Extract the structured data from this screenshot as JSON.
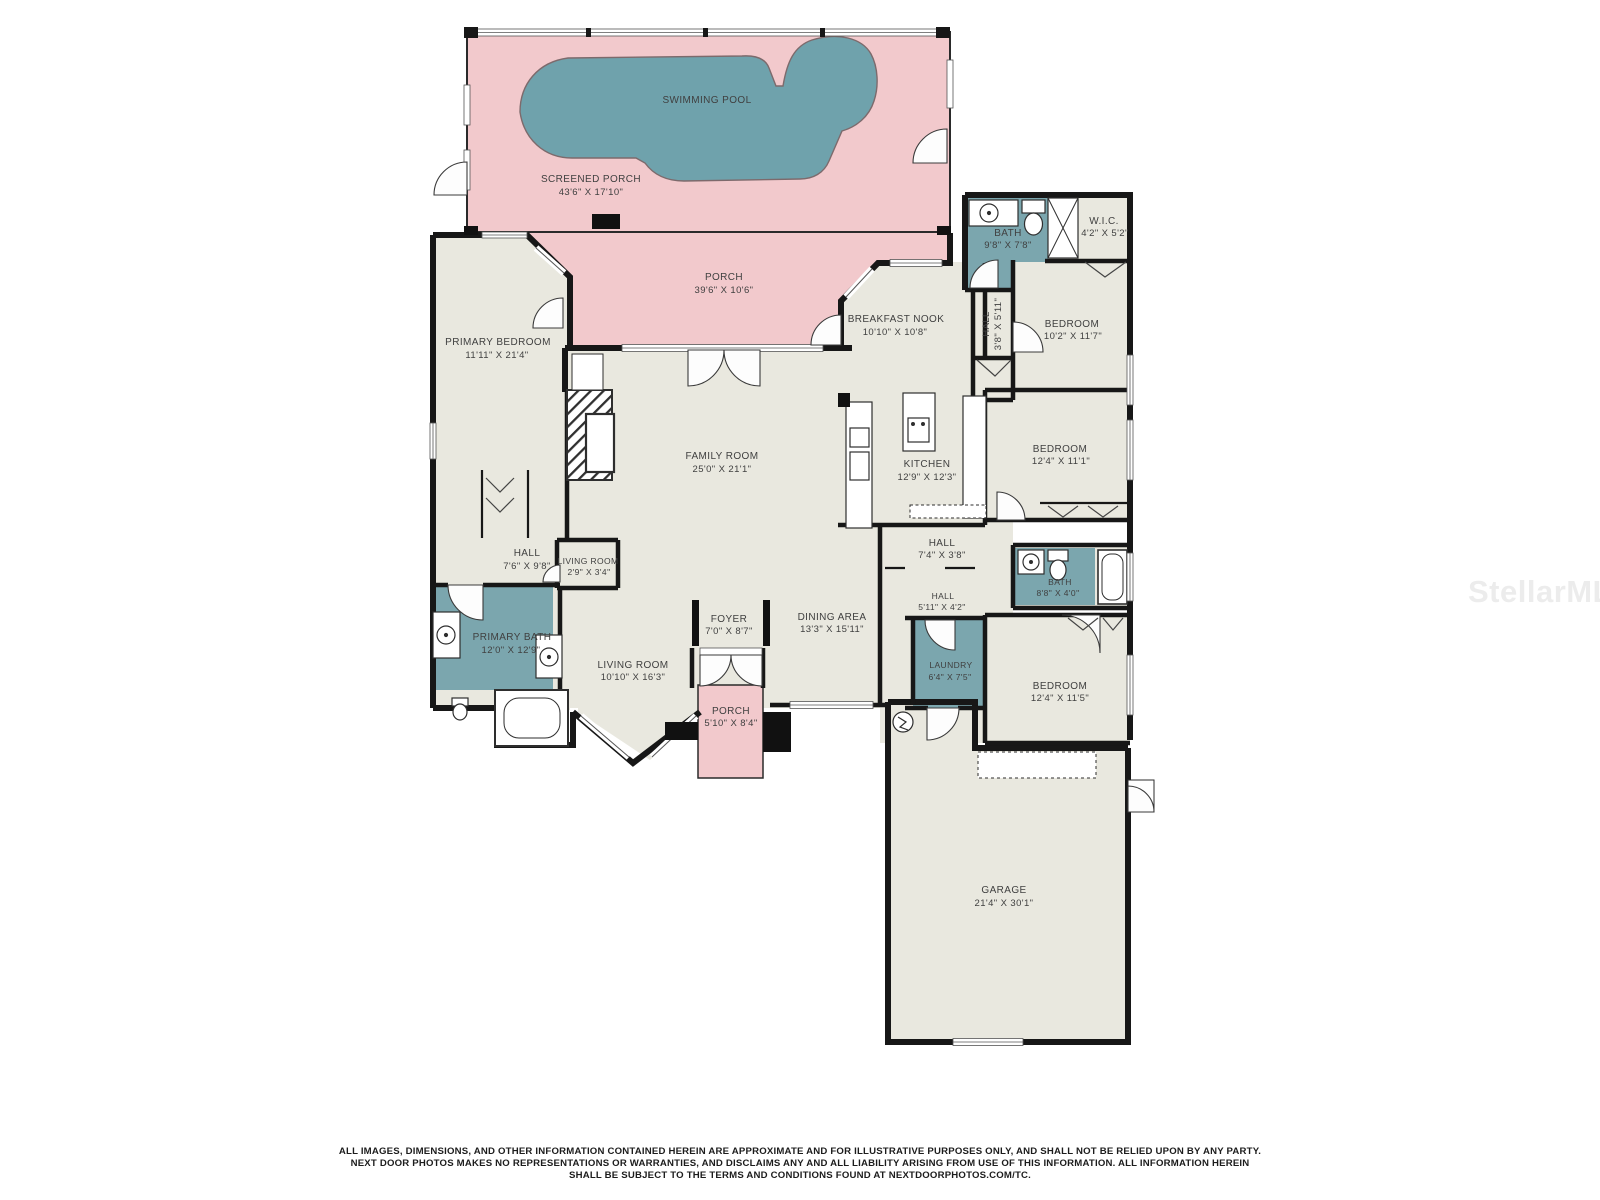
{
  "watermark": "StellarMLS",
  "colors": {
    "room_fill": "#e9e8df",
    "porch_fill": "#f2c9cc",
    "bath_fill": "#7ba6ae",
    "pool_fill": "#6fa2ac",
    "wall": "#171717",
    "label_text": "#404040",
    "watermark_text": "#ececec"
  },
  "rooms": {
    "swimming_pool": {
      "name": "SWIMMING POOL",
      "dims": ""
    },
    "screened_porch": {
      "name": "SCREENED PORCH",
      "dims": "43'6\" X 17'10\""
    },
    "porch_top": {
      "name": "PORCH",
      "dims": "39'6\" X 10'6\""
    },
    "primary_bedroom": {
      "name": "PRIMARY BEDROOM",
      "dims": "11'11\" X 21'4\""
    },
    "breakfast_nook": {
      "name": "BREAKFAST NOOK",
      "dims": "10'10\" X 10'8\""
    },
    "bath_top": {
      "name": "BATH",
      "dims": "9'8\" X 7'8\""
    },
    "wic": {
      "name": "W.I.C.",
      "dims": "4'2\" X 5'2\""
    },
    "hall_vert": {
      "name": "HALL",
      "dims": "3'8\" X 5'11\""
    },
    "bedroom_top": {
      "name": "BEDROOM",
      "dims": "10'2\" X 11'7\""
    },
    "family_room": {
      "name": "FAMILY ROOM",
      "dims": "25'0\" X 21'1\""
    },
    "kitchen": {
      "name": "KITCHEN",
      "dims": "12'9\" X 12'3\""
    },
    "bedroom_mid": {
      "name": "BEDROOM",
      "dims": "12'4\" X 11'1\""
    },
    "hall_mid": {
      "name": "HALL",
      "dims": "7'4\" X 3'8\""
    },
    "hall_left": {
      "name": "HALL",
      "dims": "7'6\" X 9'8\""
    },
    "living_small": {
      "name": "LIVING ROOM",
      "dims": "2'9\" X 3'4\""
    },
    "primary_bath": {
      "name": "PRIMARY BATH",
      "dims": "12'0\" X 12'9\""
    },
    "foyer": {
      "name": "FOYER",
      "dims": "7'0\" X 8'7\""
    },
    "dining_area": {
      "name": "DINING AREA",
      "dims": "13'3\" X 15'11\""
    },
    "living_room": {
      "name": "LIVING ROOM",
      "dims": "10'10\" X 16'3\""
    },
    "hall_small": {
      "name": "HALL",
      "dims": "5'11\" X 4'2\""
    },
    "bath_small": {
      "name": "BATH",
      "dims": "8'8\" X 4'0\""
    },
    "laundry": {
      "name": "LAUNDRY",
      "dims": "6'4\" X 7'5\""
    },
    "bedroom_bottom": {
      "name": "BEDROOM",
      "dims": "12'4\" X 11'5\""
    },
    "porch_entry": {
      "name": "PORCH",
      "dims": "5'10\" X 8'4\""
    },
    "garage": {
      "name": "GARAGE",
      "dims": "21'4\" X 30'1\""
    }
  },
  "disclaimer": {
    "line1": "ALL IMAGES, DIMENSIONS, AND OTHER INFORMATION CONTAINED HEREIN ARE APPROXIMATE AND FOR ILLUSTRATIVE PURPOSES ONLY, AND SHALL NOT BE RELIED UPON BY ANY PARTY.",
    "line2": "NEXT DOOR PHOTOS MAKES NO REPRESENTATIONS OR WARRANTIES, AND DISCLAIMS ANY AND ALL LIABILITY ARISING FROM USE OF THIS INFORMATION. ALL INFORMATION HEREIN",
    "line3": "SHALL BE SUBJECT TO THE TERMS AND CONDITIONS FOUND AT NEXTDOORPHOTOS.COM/TC."
  }
}
